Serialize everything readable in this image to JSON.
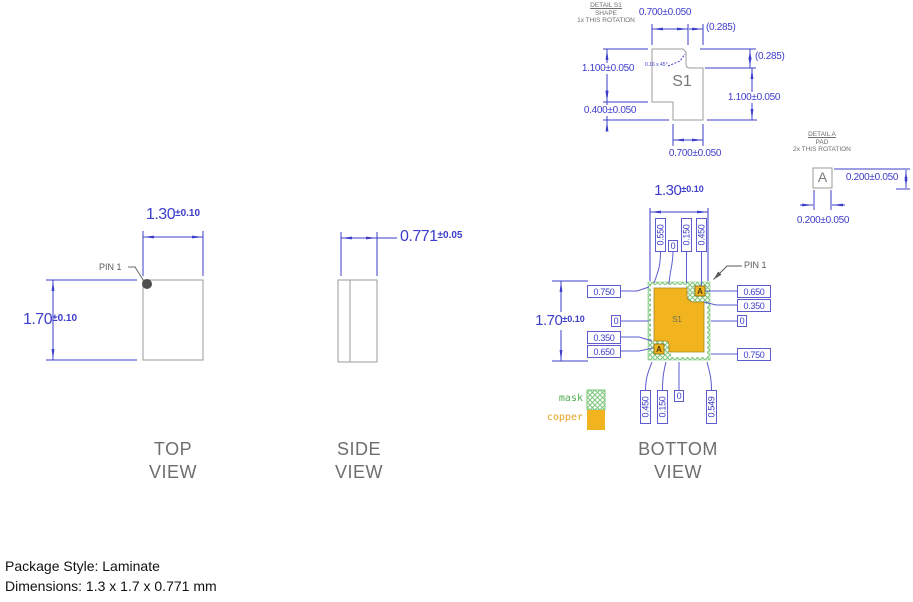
{
  "colors": {
    "dimension_blue": "#3D3DCB",
    "outline_gray": "#9B9B9B",
    "copper_orange": "#F2B41E",
    "mask_green": "#7CC67C",
    "title_gray": "#6E6E6E"
  },
  "detail_s1": {
    "title": "DETAIL S1",
    "subtitle": "SHAPE",
    "rotation_note": "1x THIS ROTATION",
    "shape_label": "S1",
    "chamfer_note": "0.16 x 45°",
    "dim_top": "0.700±0.050",
    "dim_top_ref": "(0.285)",
    "dim_right_ref": "(0.285)",
    "dim_left_upper": "1.100±0.050",
    "dim_left_lower": "0.400±0.050",
    "dim_right": "1.100±0.050",
    "dim_bottom": "0.700±0.050"
  },
  "detail_a": {
    "title": "DETAIL A",
    "subtitle": "PAD",
    "rotation_note": "2x THIS ROTATION",
    "pad_label": "A",
    "dim_height": "0.200±0.050",
    "dim_width": "0.200±0.050"
  },
  "top_view": {
    "title_line1": "TOP",
    "title_line2": "VIEW",
    "pin1_label": "PIN 1",
    "dim_width": {
      "value": "1.30",
      "tol": "±0.10"
    },
    "dim_height": {
      "value": "1.70",
      "tol": "±0.10"
    }
  },
  "side_view": {
    "title_line1": "SIDE",
    "title_line2": "VIEW",
    "dim_thickness": {
      "value": "0.771",
      "tol": "±0.05"
    }
  },
  "bottom_view": {
    "title_line1": "BOTTOM",
    "title_line2": "VIEW",
    "pin1_label": "PIN 1",
    "shape_label": "S1",
    "pad_label": "A",
    "dim_width": {
      "value": "1.30",
      "tol": "±0.10"
    },
    "dim_height": {
      "value": "1.70",
      "tol": "±0.10"
    },
    "callouts_top": [
      "0.550",
      "0",
      "0.150",
      "0.450"
    ],
    "callouts_left": [
      "0.750",
      "0",
      "0.350",
      "0.650"
    ],
    "callouts_right": [
      "0.650",
      "0.350",
      "0",
      "0.750"
    ],
    "callouts_bottom": [
      "0.450",
      "0.150",
      "0",
      "0.549"
    ]
  },
  "legend": {
    "mask_label": "mask",
    "copper_label": "copper"
  },
  "footer": {
    "line1": "Package Style: Laminate",
    "line2": "Dimensions: 1.3 x 1.7 x 0.771 mm"
  }
}
